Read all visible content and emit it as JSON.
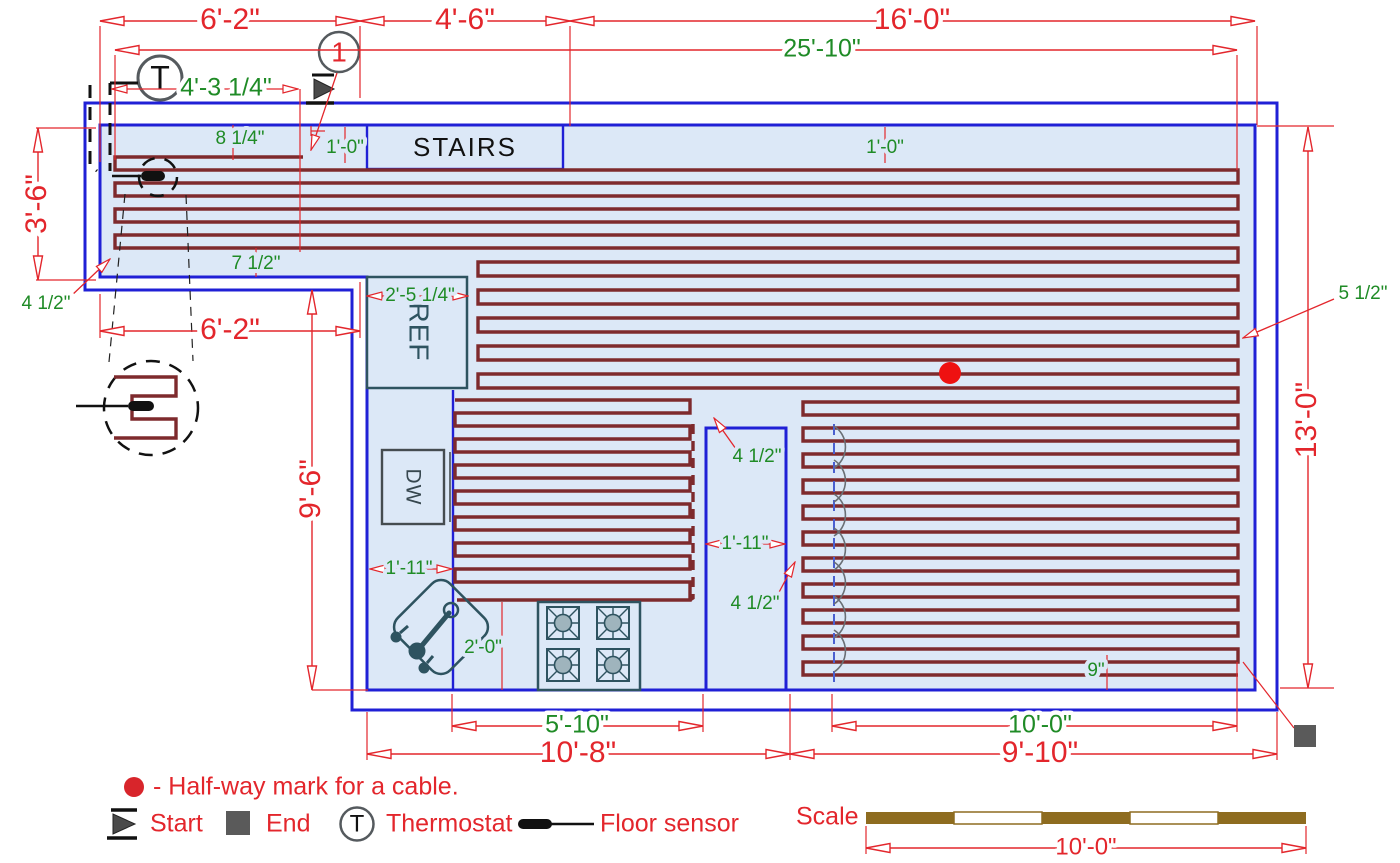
{
  "plan": {
    "stairs": "STAIRS",
    "ref": "REF",
    "dw": "DW",
    "marker_number": "1",
    "thermostat_letter": "T"
  },
  "dims": {
    "top_left": "6'-2\"",
    "top_mid": "4'-6\"",
    "top_right": "16'-0\"",
    "overall_width": "25'-10\"",
    "sensor_run": "4'-3 1/4\"",
    "cable_inset": "8 1/4\"",
    "stairs_offset": "1'-0\"",
    "room_offset": "1'-0\"",
    "arm_height": "3'-6\"",
    "arm_spacing": "7 1/2\"",
    "arm_edge": "4 1/2\"",
    "left_lower": "6'-2\"",
    "ref_width": "2'-5 1/4\"",
    "right_inset": "5 1/2\"",
    "right_height": "13'-0\"",
    "kitchen_height": "9'-6\"",
    "corridor_top": "4 1/2\"",
    "corridor_width": "1'-11\"",
    "counter_width": "1'-11\"",
    "corridor_bottom": "4 1/2\"",
    "stove_offset": "2'-0\"",
    "bottom_inset": "9\"",
    "kitchen_width": "5'-10\"",
    "kitchen_total": "10'-8\"",
    "right_width": "10'-0\"",
    "right_total": "9'-10\""
  },
  "legend": {
    "halfway": "- Half-way mark for a cable.",
    "start": "Start",
    "end": "End",
    "thermostat": "Thermostat",
    "floor_sensor": "Floor sensor"
  },
  "scale": {
    "label": "Scale",
    "length": "10'-0\""
  },
  "colors": {
    "wall_blue": "#2020d6",
    "floor_fill": "#dce8f7",
    "cable_dark_red": "#7e2a2d",
    "dimension_red": "#e3262c",
    "dimension_green": "#1f8b26",
    "fixture_teal": "#2e5360",
    "symbol_gray": "#555a5e",
    "halfway_red": "#ee1111",
    "scale_brown": "#8e6c20"
  }
}
